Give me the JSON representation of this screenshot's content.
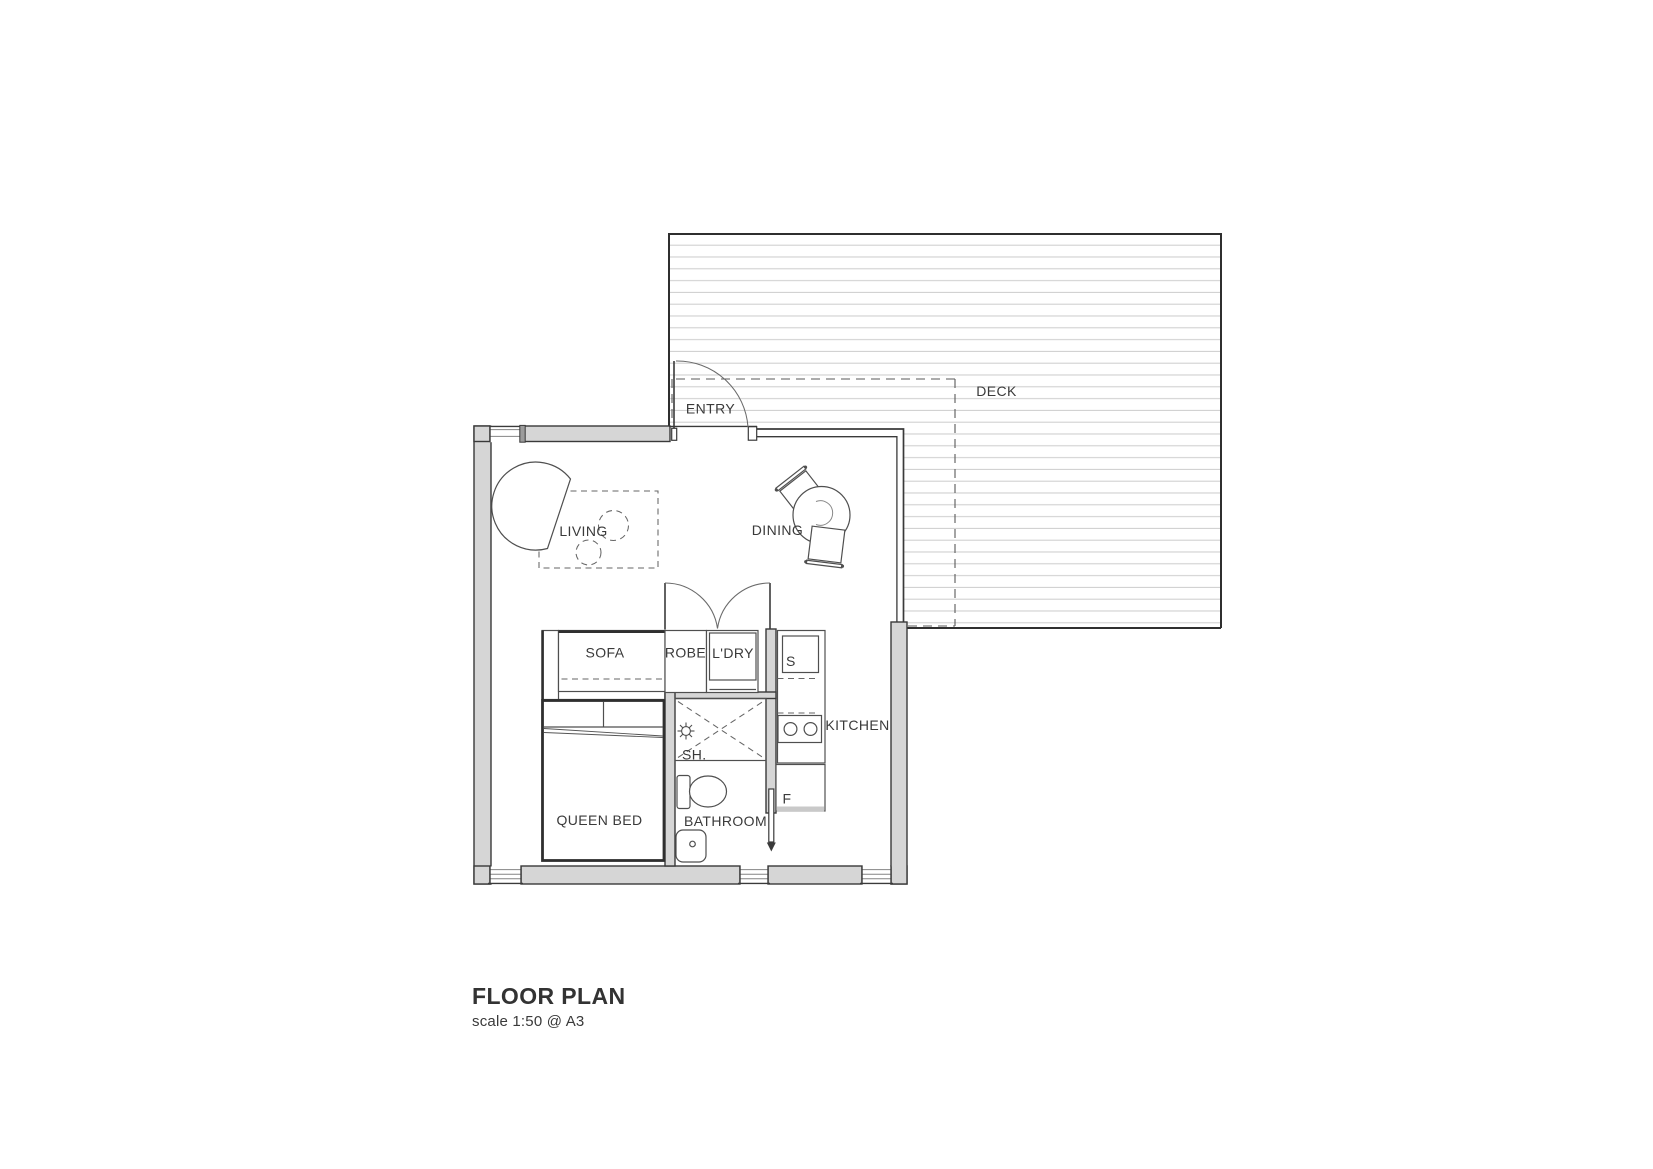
{
  "title": {
    "heading": "FLOOR PLAN",
    "scale_note": "scale 1:50 @ A3"
  },
  "plan": {
    "labels": {
      "deck": "DECK",
      "entry": "ENTRY",
      "living": "LIVING",
      "dining": "DINING",
      "sofa": "SOFA",
      "robe": "ROBE",
      "laundry": "L'DRY",
      "sink": "S",
      "kitchen": "KITCHEN",
      "fridge": "F",
      "shower": "SH.",
      "bathroom": "BATHROOM",
      "queen_bed": "QUEEN BED"
    },
    "colors": {
      "wall_fill": "#d6d6d6",
      "outline": "#3a3a3a",
      "deck_board_line": "#cbcbcb",
      "dashed_overhang": "#5a5a5a",
      "text": "#3a3a3a"
    }
  }
}
